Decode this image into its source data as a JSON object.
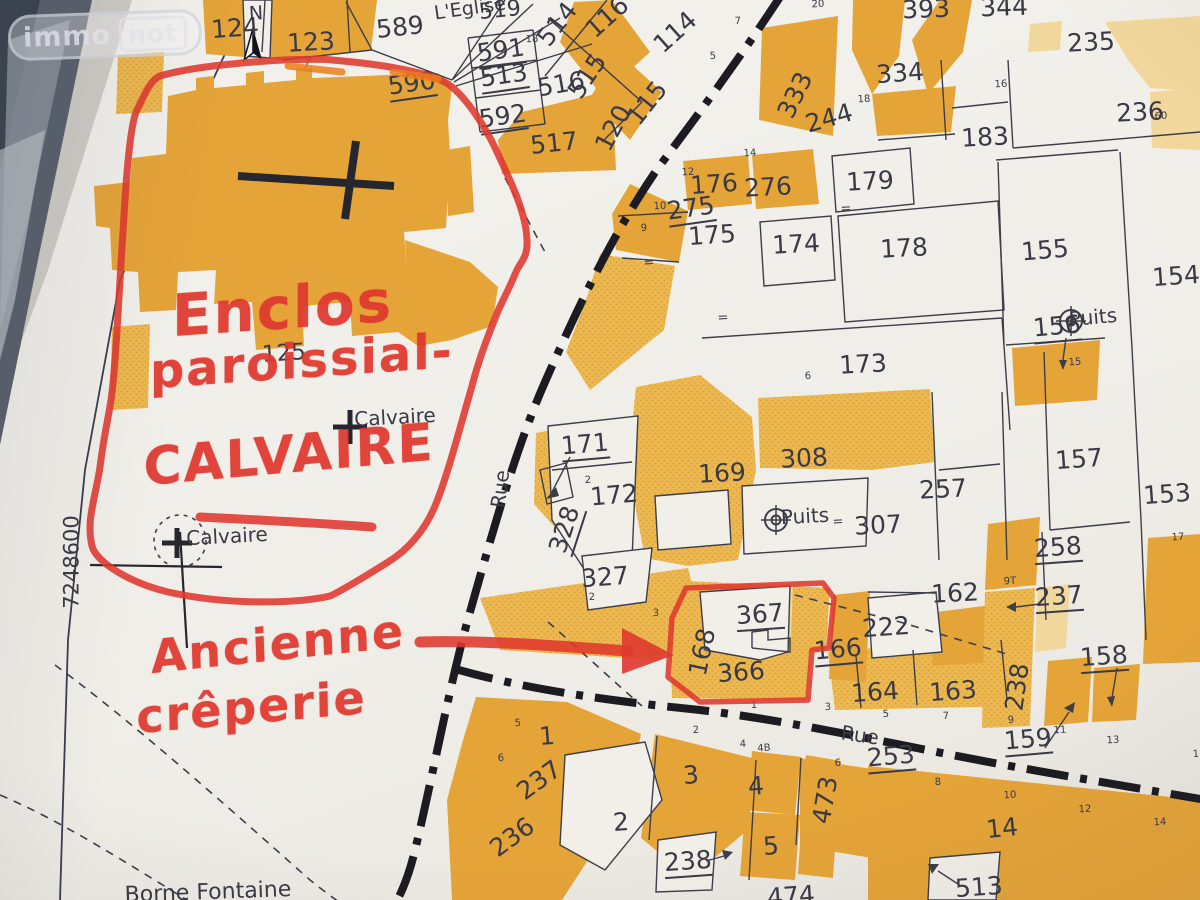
{
  "logo": {
    "immo": "immo",
    "not": "not"
  },
  "colors": {
    "annotation_red": "#df382e",
    "building_orange": "#e5a438",
    "parcel_orange": "#ecb852",
    "light_orange": "#f2d79c",
    "ink": "#3e3e4a",
    "highlight_orange": "#ec7c1c",
    "road_black": "#1b1b21",
    "paper": "#f2efe9"
  },
  "annotations": {
    "handwritten": [
      {
        "t": "Enclos",
        "x": 172,
        "y": 282,
        "s": 58,
        "r": -4
      },
      {
        "t": "paroissial-",
        "x": 150,
        "y": 344,
        "s": 48,
        "r": -4
      },
      {
        "t": "CALVAIRE",
        "x": 143,
        "y": 438,
        "s": 52,
        "r": -5
      },
      {
        "t": "Ancienne",
        "x": 150,
        "y": 630,
        "s": 46,
        "r": -6
      },
      {
        "t": "crêperie",
        "x": 136,
        "y": 690,
        "s": 46,
        "r": -5
      }
    ]
  },
  "map": {
    "parcel_labels": [
      {
        "t": "124",
        "x": 235,
        "y": 28,
        "r": -4
      },
      {
        "t": "123",
        "x": 311,
        "y": 42,
        "r": -3
      },
      {
        "t": "589",
        "x": 400,
        "y": 27,
        "r": -6
      },
      {
        "t": "590",
        "x": 412,
        "y": 85,
        "r": -8,
        "u": true
      },
      {
        "t": "591",
        "x": 501,
        "y": 52,
        "r": -8,
        "u": true
      },
      {
        "t": "513",
        "x": 504,
        "y": 77,
        "r": -8,
        "u": true
      },
      {
        "t": "592",
        "x": 503,
        "y": 118,
        "r": -8,
        "u": true
      },
      {
        "t": "519",
        "x": 500,
        "y": 11,
        "r": -6,
        "s": 22
      },
      {
        "t": "517",
        "x": 554,
        "y": 143,
        "r": -6
      },
      {
        "t": "516",
        "x": 561,
        "y": 84,
        "r": -10
      },
      {
        "t": "514",
        "x": 557,
        "y": 24,
        "r": -52
      },
      {
        "t": "515",
        "x": 587,
        "y": 76,
        "r": -56
      },
      {
        "t": "116",
        "x": 607,
        "y": 17,
        "r": -42
      },
      {
        "t": "114",
        "x": 675,
        "y": 32,
        "r": -42
      },
      {
        "t": "115",
        "x": 647,
        "y": 103,
        "r": -52
      },
      {
        "t": "120",
        "x": 613,
        "y": 128,
        "r": -62
      },
      {
        "t": "393",
        "x": 926,
        "y": 9,
        "r": -2
      },
      {
        "t": "344",
        "x": 1004,
        "y": 7,
        "r": -2
      },
      {
        "t": "334",
        "x": 900,
        "y": 73,
        "r": -4
      },
      {
        "t": "333",
        "x": 795,
        "y": 95,
        "r": -64
      },
      {
        "t": "244",
        "x": 829,
        "y": 118,
        "r": -16
      },
      {
        "t": "183",
        "x": 985,
        "y": 137,
        "r": -3
      },
      {
        "t": "235",
        "x": 1091,
        "y": 42,
        "r": -3
      },
      {
        "t": "236",
        "x": 1140,
        "y": 112,
        "r": -3
      },
      {
        "t": "176",
        "x": 714,
        "y": 184,
        "r": -4
      },
      {
        "t": "276",
        "x": 768,
        "y": 187,
        "r": -3
      },
      {
        "t": "179",
        "x": 870,
        "y": 181,
        "r": -3
      },
      {
        "t": "275",
        "x": 691,
        "y": 210,
        "r": -8,
        "u": true
      },
      {
        "t": "175",
        "x": 712,
        "y": 235,
        "r": -4
      },
      {
        "t": "174",
        "x": 796,
        "y": 244,
        "r": -3
      },
      {
        "t": "178",
        "x": 904,
        "y": 248,
        "r": -3
      },
      {
        "t": "173",
        "x": 863,
        "y": 364,
        "r": -3
      },
      {
        "t": "155",
        "x": 1045,
        "y": 250,
        "r": -5
      },
      {
        "t": "154",
        "x": 1176,
        "y": 276,
        "r": -4
      },
      {
        "t": "156",
        "x": 1057,
        "y": 328,
        "r": -5,
        "u": true
      },
      {
        "t": "157",
        "x": 1079,
        "y": 459,
        "r": -4
      },
      {
        "t": "153",
        "x": 1167,
        "y": 494,
        "r": -4
      },
      {
        "t": "125",
        "x": 284,
        "y": 354,
        "r": -4,
        "s": 23
      },
      {
        "t": "171",
        "x": 585,
        "y": 446,
        "r": -5,
        "u": true
      },
      {
        "t": "172",
        "x": 614,
        "y": 495,
        "r": -5
      },
      {
        "t": "328",
        "x": 566,
        "y": 530,
        "r": -72,
        "u": true
      },
      {
        "t": "327",
        "x": 605,
        "y": 577,
        "r": -4
      },
      {
        "t": "169",
        "x": 722,
        "y": 473,
        "r": -3
      },
      {
        "t": "308",
        "x": 804,
        "y": 458,
        "r": -3
      },
      {
        "t": "307",
        "x": 878,
        "y": 525,
        "r": -3
      },
      {
        "t": "257",
        "x": 943,
        "y": 489,
        "r": -3
      },
      {
        "t": "258",
        "x": 1058,
        "y": 549,
        "r": -4,
        "u": true
      },
      {
        "t": "237",
        "x": 1059,
        "y": 598,
        "r": -4,
        "u": true
      },
      {
        "t": "238",
        "x": 1017,
        "y": 687,
        "r": -82
      },
      {
        "t": "158",
        "x": 1104,
        "y": 658,
        "r": -4,
        "u": true
      },
      {
        "t": "159",
        "x": 1028,
        "y": 741,
        "r": -5,
        "u": true
      },
      {
        "t": "162",
        "x": 955,
        "y": 593,
        "r": -3
      },
      {
        "t": "222",
        "x": 886,
        "y": 627,
        "r": -4
      },
      {
        "t": "164",
        "x": 875,
        "y": 692,
        "r": -4
      },
      {
        "t": "163",
        "x": 953,
        "y": 691,
        "r": -4
      },
      {
        "t": "166",
        "x": 838,
        "y": 651,
        "r": -5,
        "u": true
      },
      {
        "t": "367",
        "x": 760,
        "y": 616,
        "r": -4,
        "u": true
      },
      {
        "t": "168",
        "x": 702,
        "y": 652,
        "r": -78
      },
      {
        "t": "366",
        "x": 741,
        "y": 672,
        "r": -4
      },
      {
        "t": "253",
        "x": 891,
        "y": 758,
        "r": -5,
        "u": true
      },
      {
        "t": "473",
        "x": 825,
        "y": 800,
        "r": -80
      },
      {
        "t": "474",
        "x": 791,
        "y": 896,
        "r": -4
      },
      {
        "t": "513",
        "x": 979,
        "y": 889,
        "r": -4,
        "u": true
      },
      {
        "t": "14",
        "x": 1002,
        "y": 828,
        "r": -6
      },
      {
        "t": "1",
        "x": 547,
        "y": 736,
        "r": -4
      },
      {
        "t": "237",
        "x": 539,
        "y": 780,
        "r": -36
      },
      {
        "t": "236",
        "x": 512,
        "y": 837,
        "r": -36
      },
      {
        "t": "2",
        "x": 621,
        "y": 822,
        "r": -4
      },
      {
        "t": "3",
        "x": 691,
        "y": 775,
        "r": -4
      },
      {
        "t": "4",
        "x": 756,
        "y": 786,
        "r": -4
      },
      {
        "t": "5",
        "x": 771,
        "y": 846,
        "r": -4
      },
      {
        "t": "238",
        "x": 688,
        "y": 863,
        "r": -4,
        "u": true
      }
    ],
    "place_labels": [
      {
        "t": "N",
        "x": 256,
        "y": 14,
        "s": 19,
        "r": -3,
        "n": "north-label"
      },
      {
        "t": "L'Eglise",
        "x": 470,
        "y": 9,
        "s": 19,
        "r": -8,
        "n": "place-label-eglise"
      },
      {
        "t": "Calvaire",
        "x": 395,
        "y": 417,
        "s": 20,
        "r": -3,
        "n": "place-label-calvaire"
      },
      {
        "t": "Calvaire",
        "x": 227,
        "y": 536,
        "s": 20,
        "r": -3,
        "n": "place-label-calvaire"
      },
      {
        "t": "Puits",
        "x": 1093,
        "y": 317,
        "s": 20,
        "r": -5,
        "n": "place-label-puits"
      },
      {
        "t": "Puits",
        "x": 805,
        "y": 516,
        "s": 20,
        "r": -3,
        "n": "place-label-puits"
      },
      {
        "t": "Rue",
        "x": 500,
        "y": 489,
        "s": 20,
        "r": -83,
        "n": "street-label-rue"
      },
      {
        "t": "Rue",
        "x": 860,
        "y": 735,
        "s": 20,
        "r": 8,
        "n": "street-label-rue"
      },
      {
        "t": "Borne Fontaine",
        "x": 208,
        "y": 893,
        "s": 22,
        "r": -2,
        "n": "place-label-borne-fontaine"
      },
      {
        "t": "7248600",
        "x": 72,
        "y": 562,
        "s": 21,
        "r": -90,
        "n": "grid-coordinate"
      }
    ],
    "small_labels": [
      {
        "t": "18",
        "x": 532,
        "y": 40
      },
      {
        "t": "20",
        "x": 818,
        "y": 5
      },
      {
        "t": "7",
        "x": 738,
        "y": 22
      },
      {
        "t": "5",
        "x": 713,
        "y": 57
      },
      {
        "t": "16",
        "x": 1001,
        "y": 85
      },
      {
        "t": "18",
        "x": 864,
        "y": 100
      },
      {
        "t": "60",
        "x": 1161,
        "y": 117
      },
      {
        "t": "14",
        "x": 750,
        "y": 154
      },
      {
        "t": "12",
        "x": 688,
        "y": 173
      },
      {
        "t": "10",
        "x": 660,
        "y": 207
      },
      {
        "t": "9",
        "x": 644,
        "y": 229
      },
      {
        "t": "=",
        "x": 723,
        "y": 318,
        "s": 13
      },
      {
        "t": "=",
        "x": 649,
        "y": 263,
        "s": 13
      },
      {
        "t": "=",
        "x": 846,
        "y": 209,
        "s": 13
      },
      {
        "t": "6",
        "x": 808,
        "y": 377
      },
      {
        "t": "15",
        "x": 1075,
        "y": 363
      },
      {
        "t": "2",
        "x": 588,
        "y": 481
      },
      {
        "t": "17",
        "x": 1178,
        "y": 538
      },
      {
        "t": "=",
        "x": 838,
        "y": 522,
        "s": 13
      },
      {
        "t": "9T",
        "x": 1010,
        "y": 582
      },
      {
        "t": "2",
        "x": 592,
        "y": 598
      },
      {
        "t": "3",
        "x": 656,
        "y": 614
      },
      {
        "t": "1",
        "x": 754,
        "y": 706
      },
      {
        "t": "3",
        "x": 828,
        "y": 708
      },
      {
        "t": "5",
        "x": 886,
        "y": 715
      },
      {
        "t": "7",
        "x": 946,
        "y": 717
      },
      {
        "t": "9",
        "x": 1011,
        "y": 721
      },
      {
        "t": "11",
        "x": 1060,
        "y": 731
      },
      {
        "t": "13",
        "x": 1113,
        "y": 741
      },
      {
        "t": "1",
        "x": 1196,
        "y": 755
      },
      {
        "t": "5",
        "x": 518,
        "y": 724
      },
      {
        "t": "6",
        "x": 501,
        "y": 759
      },
      {
        "t": "2",
        "x": 696,
        "y": 731
      },
      {
        "t": "4",
        "x": 743,
        "y": 745
      },
      {
        "t": "4B",
        "x": 764,
        "y": 749
      },
      {
        "t": "6",
        "x": 838,
        "y": 764
      },
      {
        "t": "8",
        "x": 938,
        "y": 783
      },
      {
        "t": "10",
        "x": 1010,
        "y": 796
      },
      {
        "t": "12",
        "x": 1085,
        "y": 810
      },
      {
        "t": "14",
        "x": 1160,
        "y": 823
      }
    ]
  }
}
